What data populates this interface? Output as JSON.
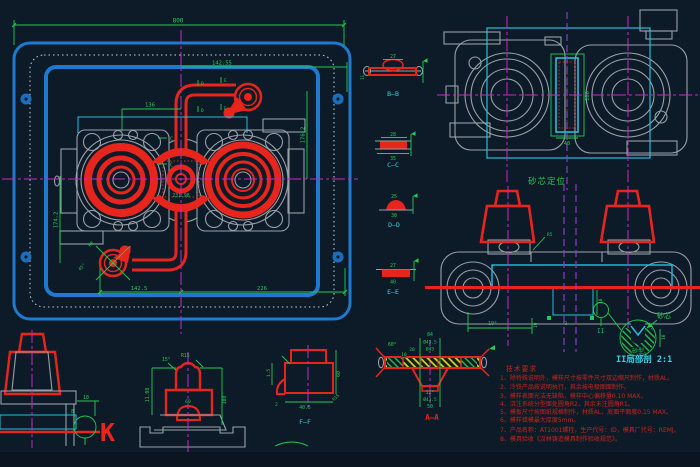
{
  "canvas": {
    "width": 700,
    "height": 467
  },
  "labels": {
    "bb": "B—B",
    "cc": "C—C",
    "dd": "D—D",
    "ee": "E—E",
    "aa": "A—A",
    "ff": "F—F",
    "k": "K",
    "ii": "II",
    "core_positioning": "砂芯定位",
    "sand_core": "砂芯",
    "sand_mold": "砂型",
    "ii_caption": "II局部剖  2:1",
    "mark_c": "C",
    "mark_d": "D",
    "mark_e": "E"
  },
  "dims": {
    "plate_width": "800",
    "upper_width": "142.55",
    "boss_span": "136",
    "height_left": "174.2",
    "height_right": "176.2",
    "sprue_center": "231.98",
    "bottom_left": "142.5",
    "bottom_right": "226",
    "gate_radius": "R8",
    "gate_angle": "45°",
    "bb_width": "27",
    "bb_side": "11",
    "cc_top": "28",
    "cc_bottom": "35",
    "dd_top": "25",
    "dd_bottom": "30",
    "ee_top": "27",
    "ee_bottom": "40",
    "core_height": "180",
    "core_width": "40",
    "elev_angle": "10°",
    "elev_depth": "10",
    "elev_gap": "3",
    "elev_radius": "R5",
    "detail_depth": "10",
    "k_offset": "10",
    "k_step": "8",
    "dome_angle": "15°",
    "dome_radius": "R15",
    "dome_height": "11.08",
    "dome_side": "100",
    "dome_width": "60",
    "ff_wall": "1.5",
    "ff_height": "60",
    "ff_width": "40.5",
    "ff_radius": "R15",
    "ff_step": "2",
    "aa_width": "84",
    "aa_dia1": "Ø43.5",
    "aa_dia2": "Ø43",
    "aa_t1": "20",
    "aa_t2": "10",
    "aa_angle1": "60°",
    "aa_angle2": "12°",
    "aa_dia3": "Ø43.5",
    "aa_bottom": "50"
  },
  "notes": {
    "title": "技术要求",
    "items": [
      "1、除特殊说明外，模样尺寸按零件尺寸双边缩尺制作，材质AL。",
      "2、冷铁产品按说明执行，其余按电极图面制作。",
      "3、模样表面光洁无缺陷，模样中心偏移量0.10 MAX。",
      "4、浇注系统分型面处圆角R2，其余未注圆角R1。",
      "5、模板尺寸按图纸规格制作，材质AL，底面平面度0.15 MAX。",
      "6、模样错模最大厚度5mm。",
      "7、产品名称：AT1001螺栓，生产代号：ID，模具厂代号：REMJ。",
      "8、模具验收《汉林铸造模具制作验收规范》。"
    ]
  },
  "colors": {
    "background": "#0d1b28",
    "plate_blue": "#1d7ad0",
    "gate_red": "#e8251c",
    "dimension_green": "#1ecb53",
    "centerline_magenta": "#c328c3",
    "part_gray": "#98a0a8",
    "core_cyan": "#24bede",
    "hatch_yellow": "#c9cd3b",
    "note_red": "#c8251c",
    "label_cyan": "#2bd2e4",
    "phantom_purple": "#8a3cc8"
  }
}
